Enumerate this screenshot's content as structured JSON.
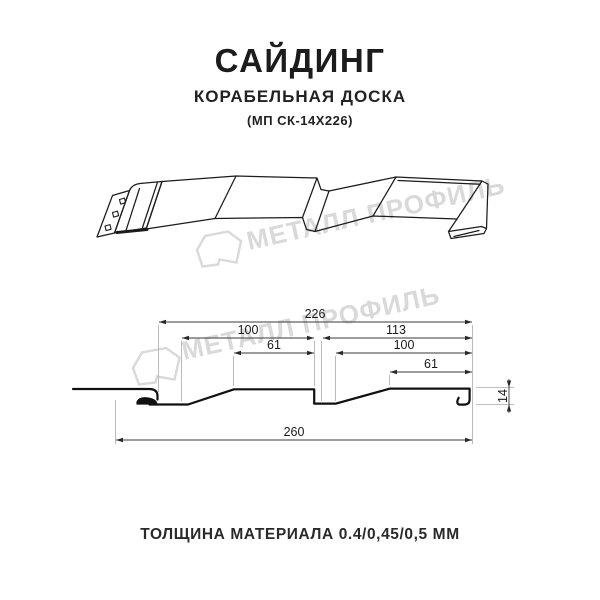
{
  "header": {
    "title": "САЙДИНГ",
    "subtitle": "КОРАБЕЛЬНАЯ ДОСКА",
    "model": "(МП СК-14Х226)"
  },
  "watermark": {
    "brand": "МЕТАЛЛ ПРОФИЛЬ",
    "color": "#d9d9d9"
  },
  "section_view": {
    "dims": {
      "top_width": "226",
      "left_panel": "100",
      "left_flat": "61",
      "right_panel": "113",
      "right_inner": "100",
      "right_flat": "61",
      "bottom_width": "260",
      "height": "14"
    }
  },
  "footer": {
    "thickness": "ТОЛЩИНА МАТЕРИАЛА 0.4/0,45/0,5 ММ"
  }
}
